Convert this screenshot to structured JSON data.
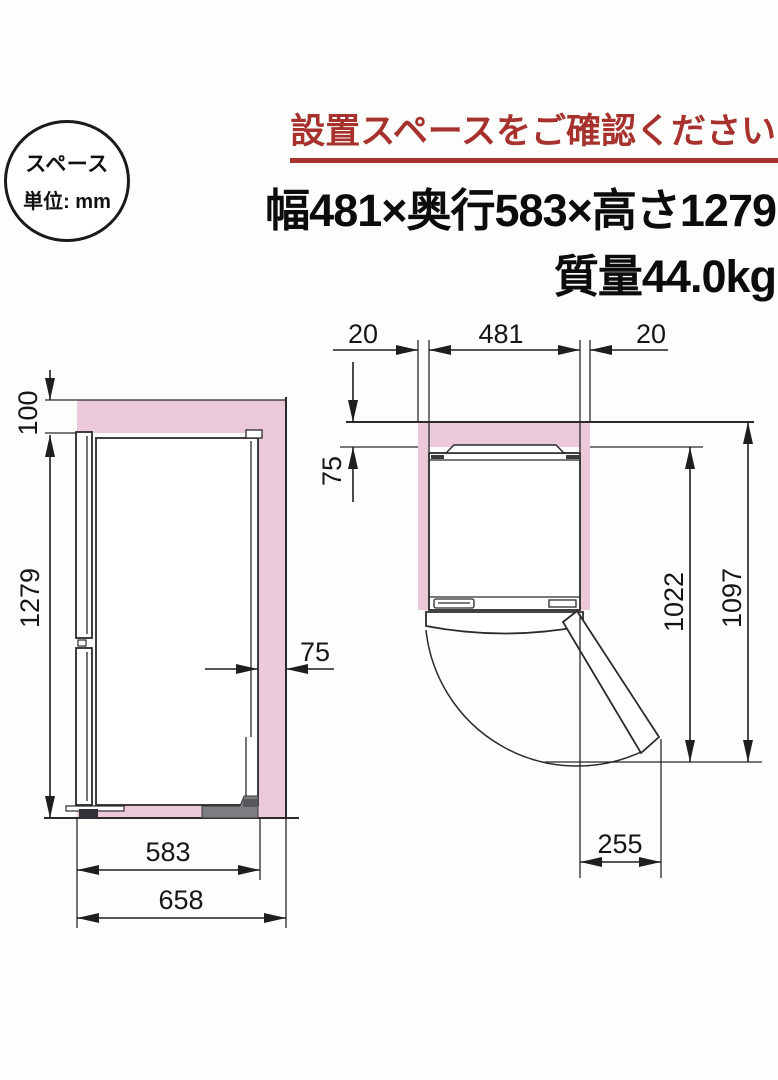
{
  "badge": {
    "line1": "スペース",
    "line2": "単位: mm"
  },
  "header": {
    "warning": "設置スペースをご確認ください",
    "size_line": "幅481×奥行583×高さ1279",
    "weight_line": "質量44.0kg"
  },
  "side_view": {
    "top_clearance": "100",
    "height": "1279",
    "rear_clearance": "75",
    "depth": "583",
    "total_depth": "658"
  },
  "top_view": {
    "left_clearance": "20",
    "width": "481",
    "right_clearance": "20",
    "rear_clearance": "75",
    "door_open_depth": "1022",
    "total_open_depth": "1097",
    "door_protrusion": "255"
  },
  "colors": {
    "accent_red": "#a7322d",
    "clearance_pink": "#ecc9d8",
    "line_dark": "#2a2a2a"
  }
}
